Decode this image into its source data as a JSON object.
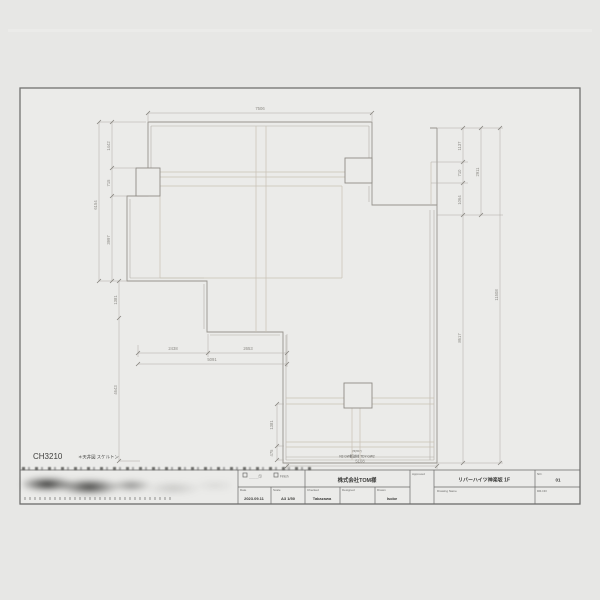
{
  "page": {
    "bg": "#e7e7e5",
    "sheet_bg": "#ebebe9"
  },
  "drawing": {
    "code": "CH3210",
    "code_note": "＊天井図 スケルトン",
    "bottom_note_1": "(≒h57)",
    "bottom_note_2": "N3 GW断熱材 TDY-GW2",
    "dims": {
      "top": "7506",
      "left_1": "1442",
      "left_2": "715",
      "left_3": "3997",
      "left_total": "6154",
      "left_low_1": "1381",
      "left_low_2": "4643",
      "bottom_1": "2438",
      "bottom_2": "2653",
      "bottom_total": "5091",
      "bottom_low": "5108",
      "mid_1": "1381",
      "mid_2": "475",
      "right_1": "1137",
      "right_2": "710",
      "right_3": "1064",
      "right_total": "2911",
      "right_long": "8617",
      "right_overall": "11508"
    }
  },
  "titleblock": {
    "checkbox1_label": "＿＿＿印",
    "checkbox2_label": "Finish",
    "date_label": "Date",
    "date_value": "2023.09.11",
    "scale_label": "Scale",
    "scale_value": "A3 1/50",
    "company": "株式会社TOM様",
    "checked_label": "Checked",
    "checked_value": "Takazawa",
    "designed_label": "Designed",
    "designed_value": "",
    "drawn_label": "Drawn",
    "drawn_value": "Isobe",
    "approved_label": "Approved",
    "drawing_name_label": "Drawing Name",
    "drawing_name_value": "リバーハイツ神楽坂 1F",
    "no_label": "NO.",
    "no_value": "01",
    "drno_label": "DR-NO"
  }
}
